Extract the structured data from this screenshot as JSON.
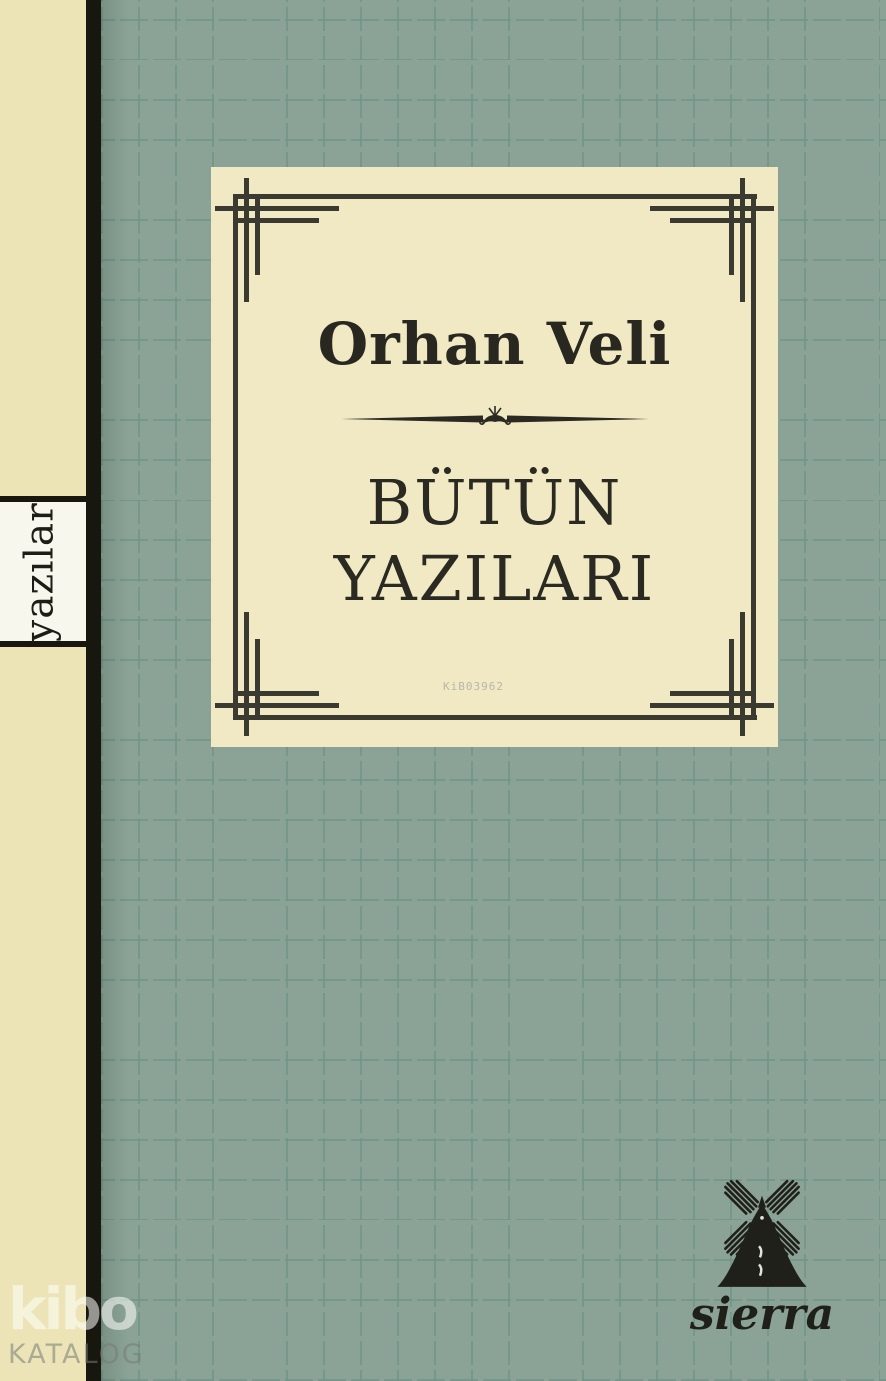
{
  "book_cover": {
    "author": "Orhan Veli",
    "title": [
      "BÜTÜN",
      "YAZILARI"
    ],
    "spine_label": "yazılar",
    "catalog_code": "KiB03962",
    "publisher_name": "sierra",
    "watermark": {
      "brand": "kibo",
      "label": "KATALOG"
    },
    "colors": {
      "panel_cream": "#f0e9c3",
      "spine_cream": "#ece4b6",
      "spine_bar_black": "#17160f",
      "cover_green": "#8ba396",
      "texture_dash_green": "#6f9486",
      "frame_line": "#3b3a31",
      "text_dark": "#2a2922",
      "catalog_code_gray": "#b9b6ab"
    }
  }
}
